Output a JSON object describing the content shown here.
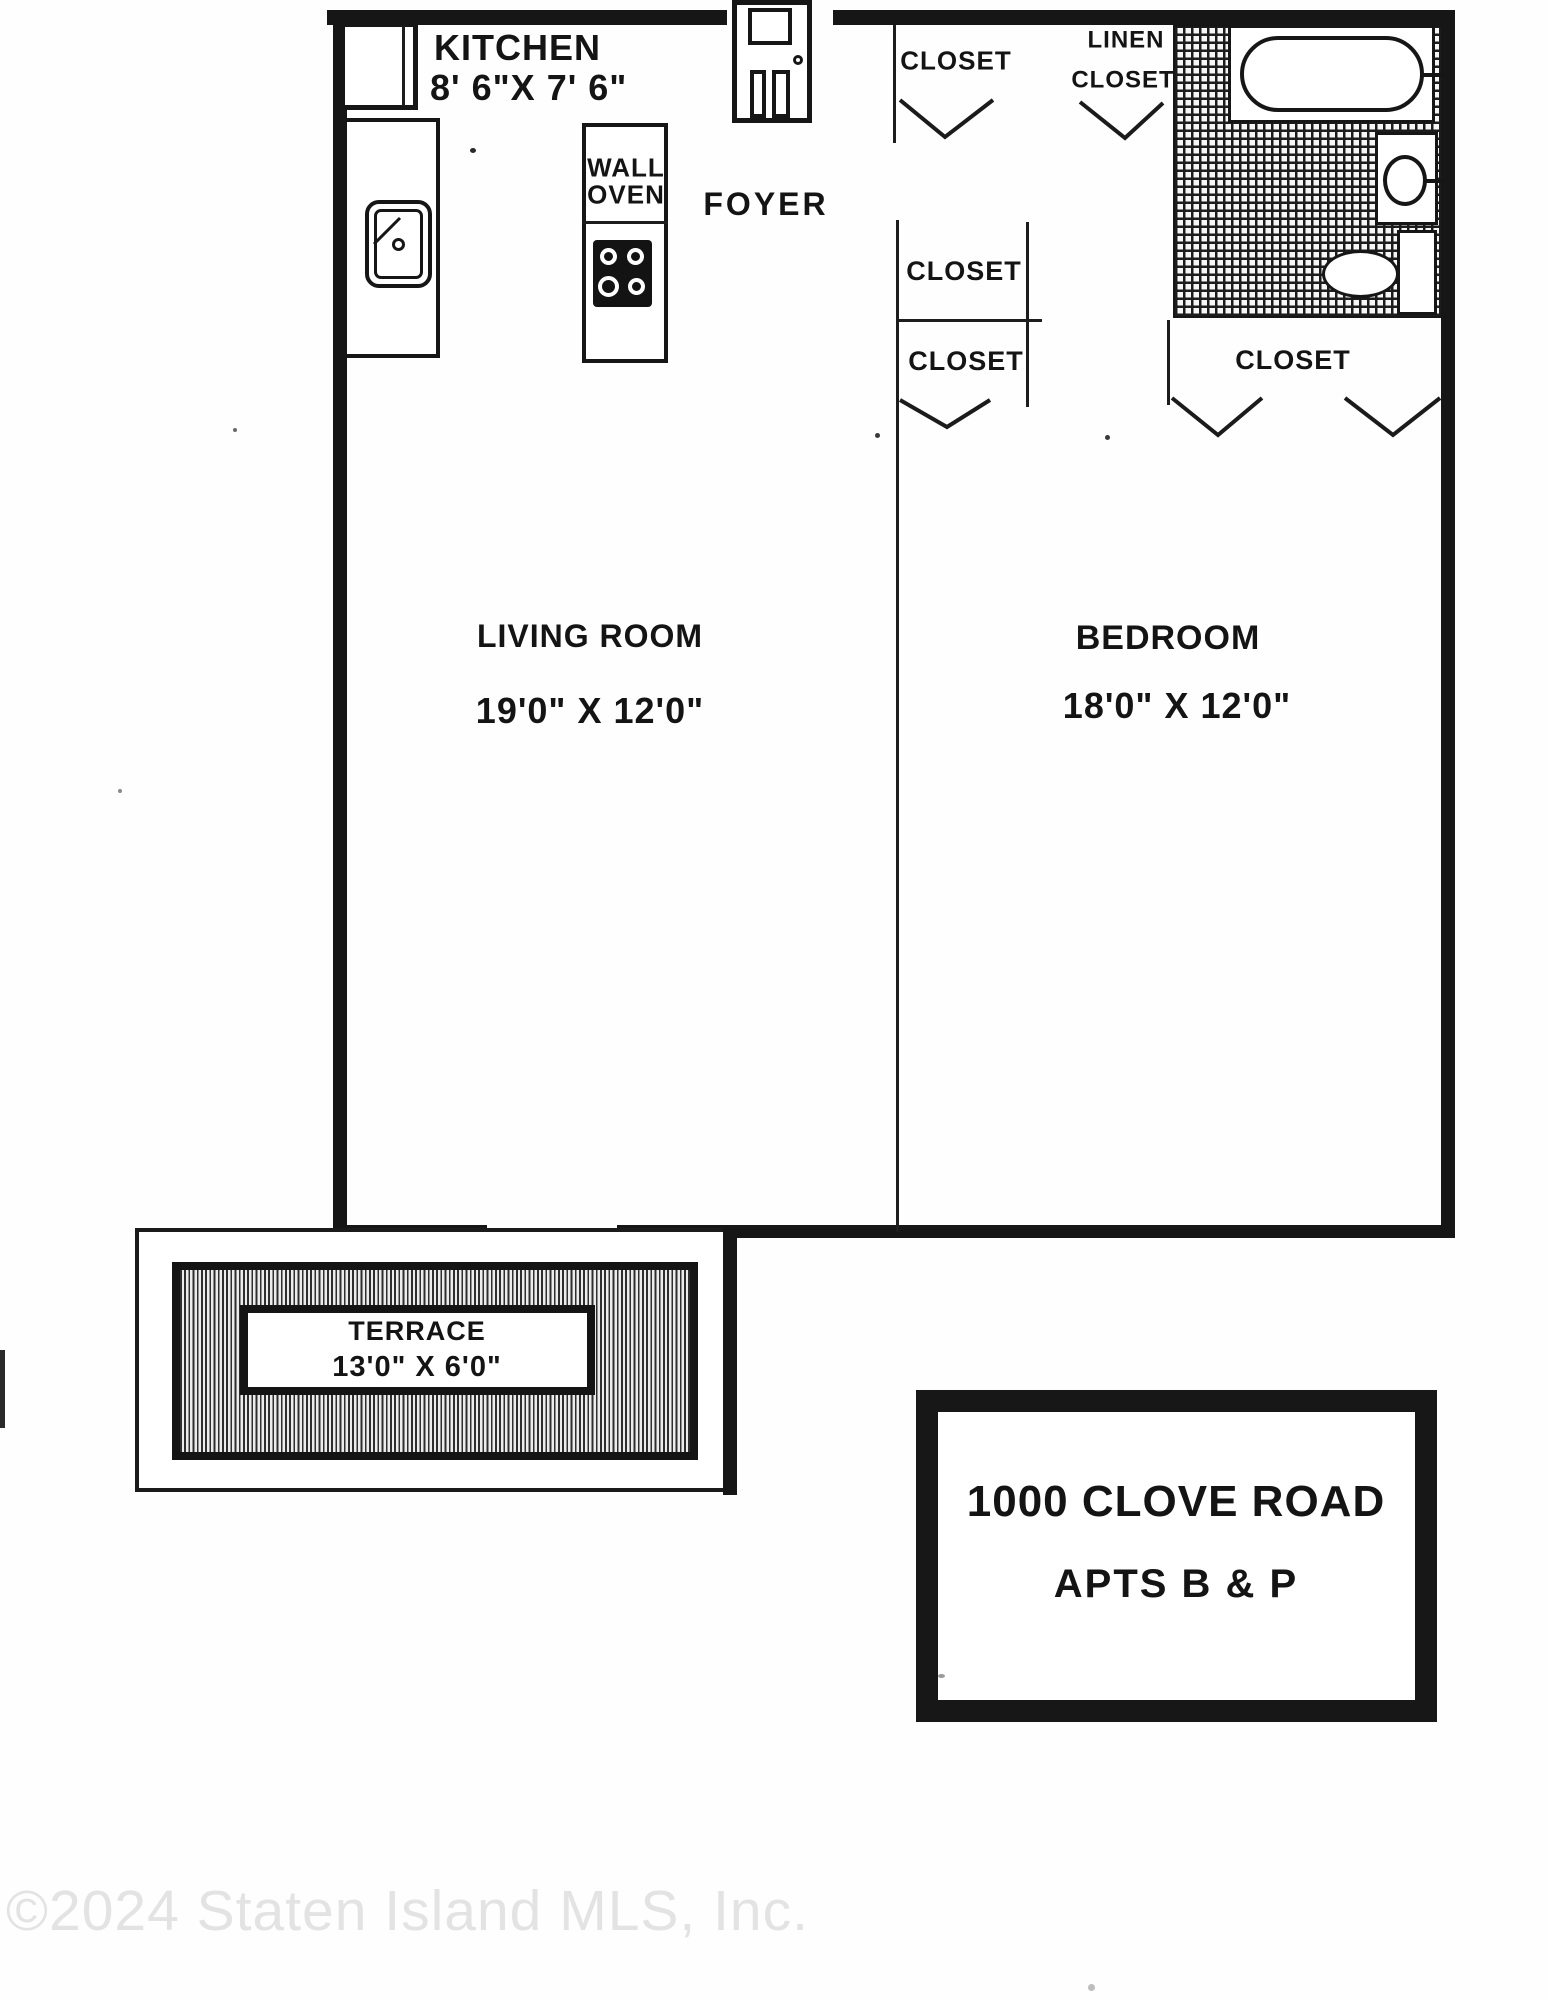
{
  "plan": {
    "rooms": {
      "kitchen": {
        "name": "KITCHEN",
        "dimensions": "8' 6\"X 7' 6\""
      },
      "foyer": {
        "name": "FOYER"
      },
      "living_room": {
        "name": "LIVING ROOM",
        "dimensions": "19'0\" X 12'0\""
      },
      "bedroom": {
        "name": "BEDROOM",
        "dimensions": "18'0\" X 12'0\""
      },
      "terrace": {
        "name": "TERRACE",
        "dimensions": "13'0\" X 6'0\""
      }
    },
    "fixtures": {
      "wall_oven_line1": "WALL",
      "wall_oven_line2": "OVEN"
    },
    "closets": {
      "foyer_closet": "CLOSET",
      "linen_line1": "LINEN",
      "linen_line2": "CLOSET",
      "hall_upper": "CLOSET",
      "hall_lower": "CLOSET",
      "bedroom_closet": "CLOSET"
    },
    "sign": {
      "line1": "1000 CLOVE ROAD",
      "line2": "APTS B & P"
    },
    "watermark": "©2024 Staten Island MLS, Inc.",
    "colors": {
      "ink": "#161616",
      "paper": "#fefefe",
      "watermark": "#e3e3e3"
    }
  }
}
